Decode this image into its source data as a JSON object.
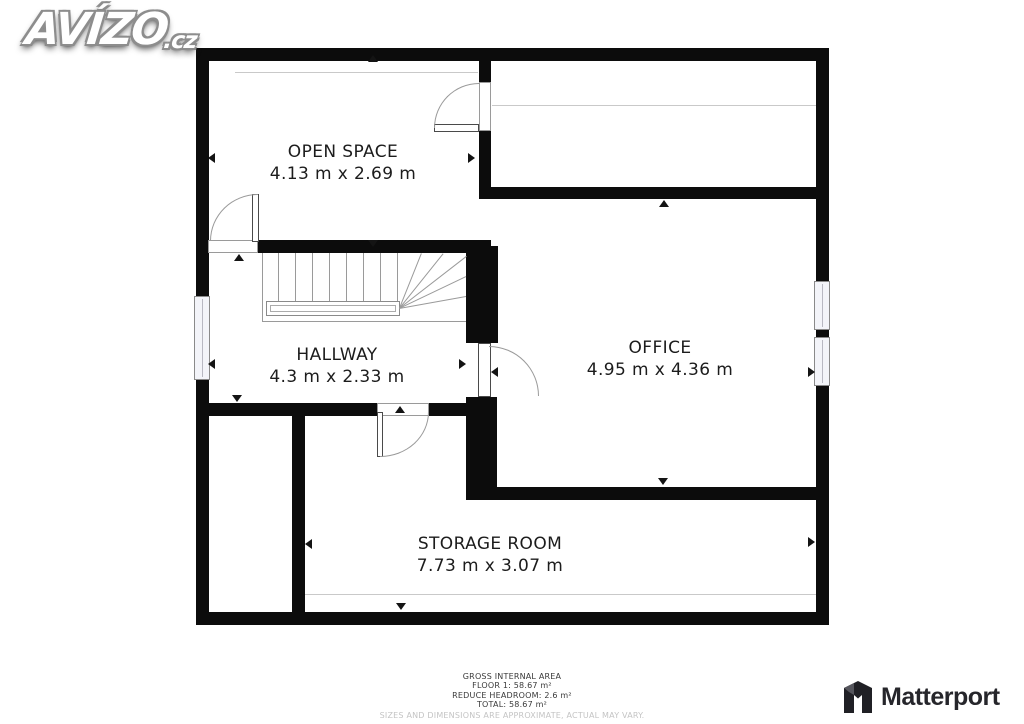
{
  "watermark": {
    "brand": "AVÍZO",
    "suffix": ".cz"
  },
  "rooms": [
    {
      "id": "open-space",
      "name": "OPEN SPACE",
      "dims": "4.13 m x 2.69 m"
    },
    {
      "id": "hallway",
      "name": "HALLWAY",
      "dims": "4.3 m x 2.33 m"
    },
    {
      "id": "office",
      "name": "OFFICE",
      "dims": "4.95 m x 4.36 m"
    },
    {
      "id": "storage-room",
      "name": "STORAGE ROOM",
      "dims": "7.73 m x 3.07 m"
    }
  ],
  "footer": {
    "title": "GROSS INTERNAL AREA",
    "floor": "FLOOR 1: 58.67 m²",
    "headroom": "REDUCE HEADROOM: 2.6 m²",
    "total": "TOTAL: 58.67 m²",
    "disclaimer": "SIZES AND DIMENSIONS ARE APPROXIMATE, ACTUAL MAY VARY."
  },
  "branding": {
    "logo_text": "Matterport"
  },
  "colors": {
    "wall": "#0c0c0c",
    "label": "#1c1c1c",
    "thin_line": "#c9c9c9",
    "window_fill": "#f3f4f9",
    "footer_text": "#3a3a3a",
    "disclaimer": "#c4c4c4"
  }
}
